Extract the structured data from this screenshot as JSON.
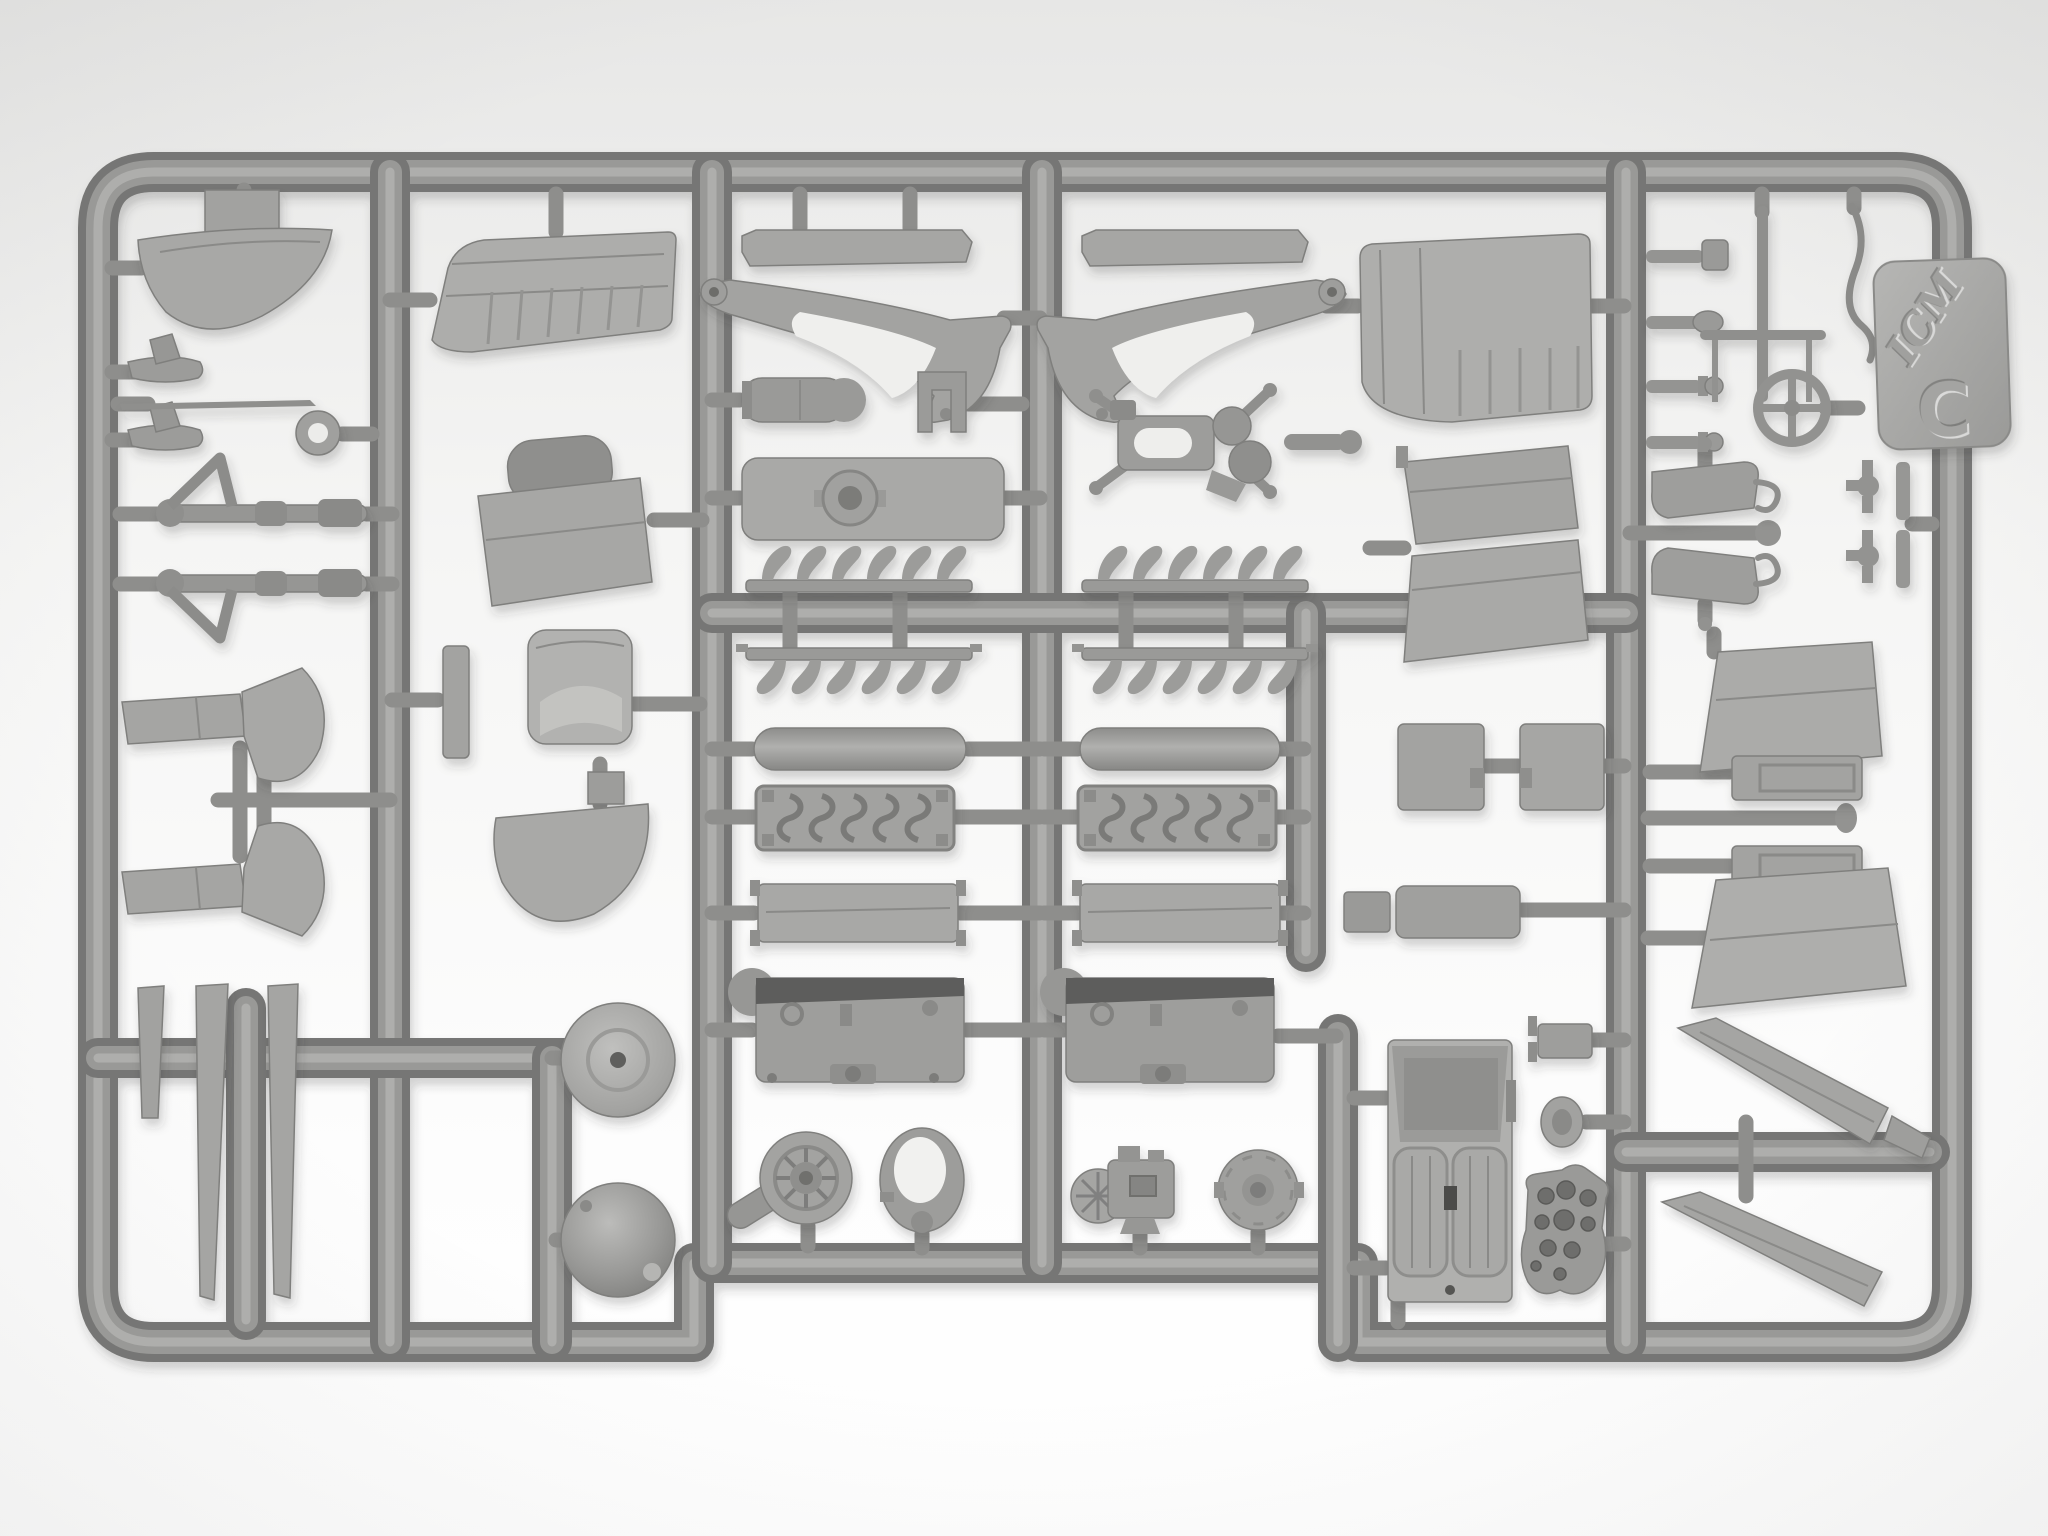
{
  "image": {
    "type": "photograph",
    "subject": "Injection-molded gray plastic model kit sprue (runner) with biplane aircraft parts, photographed on a white background",
    "background_color": "#f3f3f2",
    "plastic_color": "#9b9b99",
    "plastic_dark": "#6f6f6d",
    "plastic_light": "#b2b2b0"
  },
  "tag": {
    "brand": "ICM",
    "sprue_letter": "C"
  },
  "parts": [
    "tail-fin",
    "nose-float",
    "nose-float",
    "aerial-needle",
    "tow-ring",
    "strut-rod",
    "strut-rod",
    "wing-fairing",
    "wing-fairing",
    "interplane-strut-blade",
    "interplane-strut-blade",
    "interplane-strut-blade",
    "upper-wing-panel-left",
    "cowling-panel",
    "spacer-strip",
    "seat-back",
    "cowl-bottom-half",
    "wheel-disc",
    "spinner-dome",
    "walkway-strip",
    "walkway-strip",
    "cabane-v-strut",
    "cabane-v-strut",
    "bomb",
    "u-bracket",
    "access-panel",
    "engine-mount-bracket",
    "exhaust-stack-row",
    "exhaust-stack-row",
    "exhaust-stack-row",
    "exhaust-stack-row",
    "engine-cylinder",
    "engine-cylinder",
    "valve-cover",
    "valve-cover",
    "engine-side-panel",
    "engine-side-panel",
    "crankcase",
    "crankcase",
    "supercharger-fan",
    "intake-ring",
    "magneto",
    "propeller-hub",
    "upper-wing-panel-right",
    "aileron-flap",
    "aileron-flap",
    "radio-box",
    "radio-box",
    "equipment-box",
    "cockpit-floor-with-seats",
    "hinge-bracket",
    "access-oval",
    "instrument-panel",
    "control-knob",
    "control-knob",
    "control-knob",
    "control-knob",
    "pitot-probe",
    "antenna-whip",
    "control-handwheel",
    "air-scoop",
    "air-scoop",
    "door-latch",
    "door-latch",
    "fuselage-side-panel",
    "fuselage-side-panel",
    "fuel-tank-half",
    "fuel-tank-half",
    "wing-strut-blade",
    "wing-strut-blade",
    "brand-tag"
  ]
}
